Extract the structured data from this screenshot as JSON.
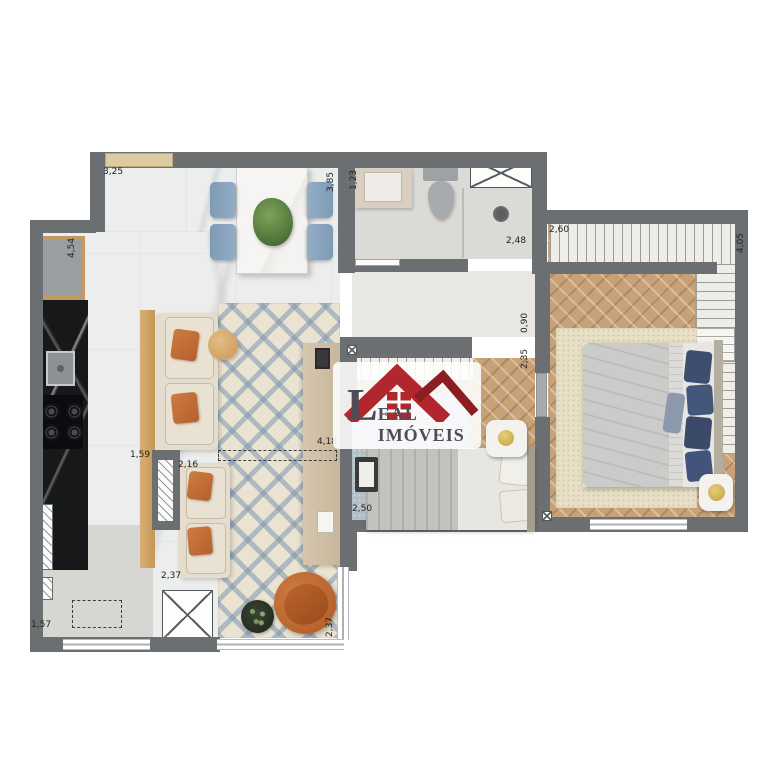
{
  "logo": {
    "initial": "L",
    "rest": "EAL IMÓVEIS",
    "full_name": "LEAL IMÓVEIS"
  },
  "colors": {
    "wall": "#6c6f72",
    "logo_red": "#b2262e",
    "logo_red_dark": "#8c1d23",
    "logo_text": "#4d4d57",
    "floor_marble": "#eceded",
    "wood_accent": "#cfa468",
    "rug_blue": "#7c96b1",
    "counter_black": "#17181a",
    "terracotta": "#c06b35",
    "pillow_navy": "#3d4e6e"
  },
  "labels": [
    {
      "text": "3,25",
      "x": 103,
      "y": 168,
      "rot": false
    },
    {
      "text": "4,54",
      "x": 68,
      "y": 258,
      "rot": true
    },
    {
      "text": "3,85",
      "x": 327,
      "y": 192,
      "rot": true
    },
    {
      "text": "1,23",
      "x": 350,
      "y": 190,
      "rot": true
    },
    {
      "text": "2,48",
      "x": 506,
      "y": 237,
      "rot": false
    },
    {
      "text": "2,60",
      "x": 549,
      "y": 226,
      "rot": false
    },
    {
      "text": "4,05",
      "x": 737,
      "y": 253,
      "rot": true
    },
    {
      "text": "0,90",
      "x": 521,
      "y": 333,
      "rot": true
    },
    {
      "text": "2,35",
      "x": 521,
      "y": 369,
      "rot": true
    },
    {
      "text": "4,18",
      "x": 317,
      "y": 438,
      "rot": false
    },
    {
      "text": "1,59",
      "x": 130,
      "y": 451,
      "rot": false
    },
    {
      "text": "2,16",
      "x": 178,
      "y": 461,
      "rot": false
    },
    {
      "text": "2,37",
      "x": 161,
      "y": 572,
      "rot": false
    },
    {
      "text": "2,50",
      "x": 352,
      "y": 505,
      "rot": false
    },
    {
      "text": "2,37",
      "x": 326,
      "y": 637,
      "rot": true
    },
    {
      "text": "1,57",
      "x": 31,
      "y": 621,
      "rot": false
    }
  ]
}
